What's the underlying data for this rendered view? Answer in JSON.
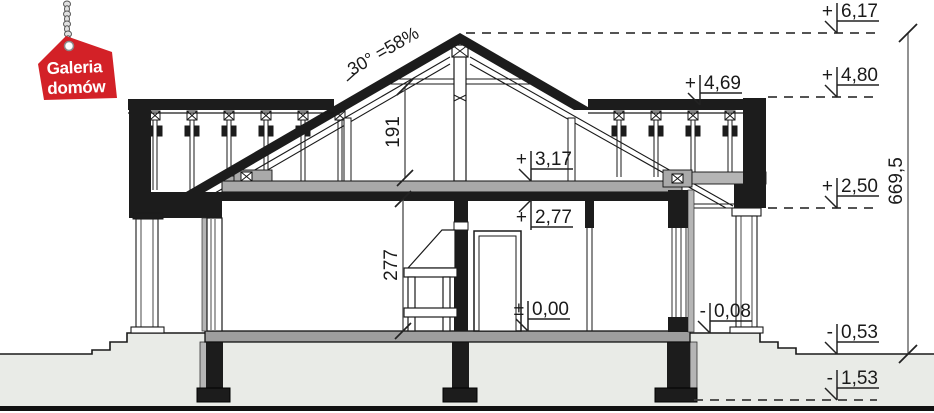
{
  "logo": {
    "line1": "Galeria",
    "line2": "domów"
  },
  "levels": {
    "ridge": {
      "sign": "+",
      "value": "6,17"
    },
    "eaves": {
      "sign": "+",
      "value": "4,80"
    },
    "wall_top": {
      "sign": "+",
      "value": "4,69"
    },
    "attic_floor": {
      "sign": "+",
      "value": "3,17"
    },
    "ceiling": {
      "sign": "+",
      "value": "2,77"
    },
    "porch_ceiling": {
      "sign": "+",
      "value": "2,50"
    },
    "ground_floor": {
      "sign": "±",
      "value": "0,00"
    },
    "terrace": {
      "sign": "-",
      "value": "0,08"
    },
    "grade": {
      "sign": "-",
      "value": "0,53"
    },
    "foundation": {
      "sign": "-",
      "value": "1,53"
    }
  },
  "dimensions": {
    "total_height": "669,5",
    "attic_clear_height": "191",
    "room_height": "277",
    "roof_pitch": "30° =58%"
  },
  "colors": {
    "tag_red": "#d32127",
    "structure_black": "#1c1c1c",
    "terrain_gray": "#e9ebe7",
    "slab_gray": "#9e9e9e"
  }
}
